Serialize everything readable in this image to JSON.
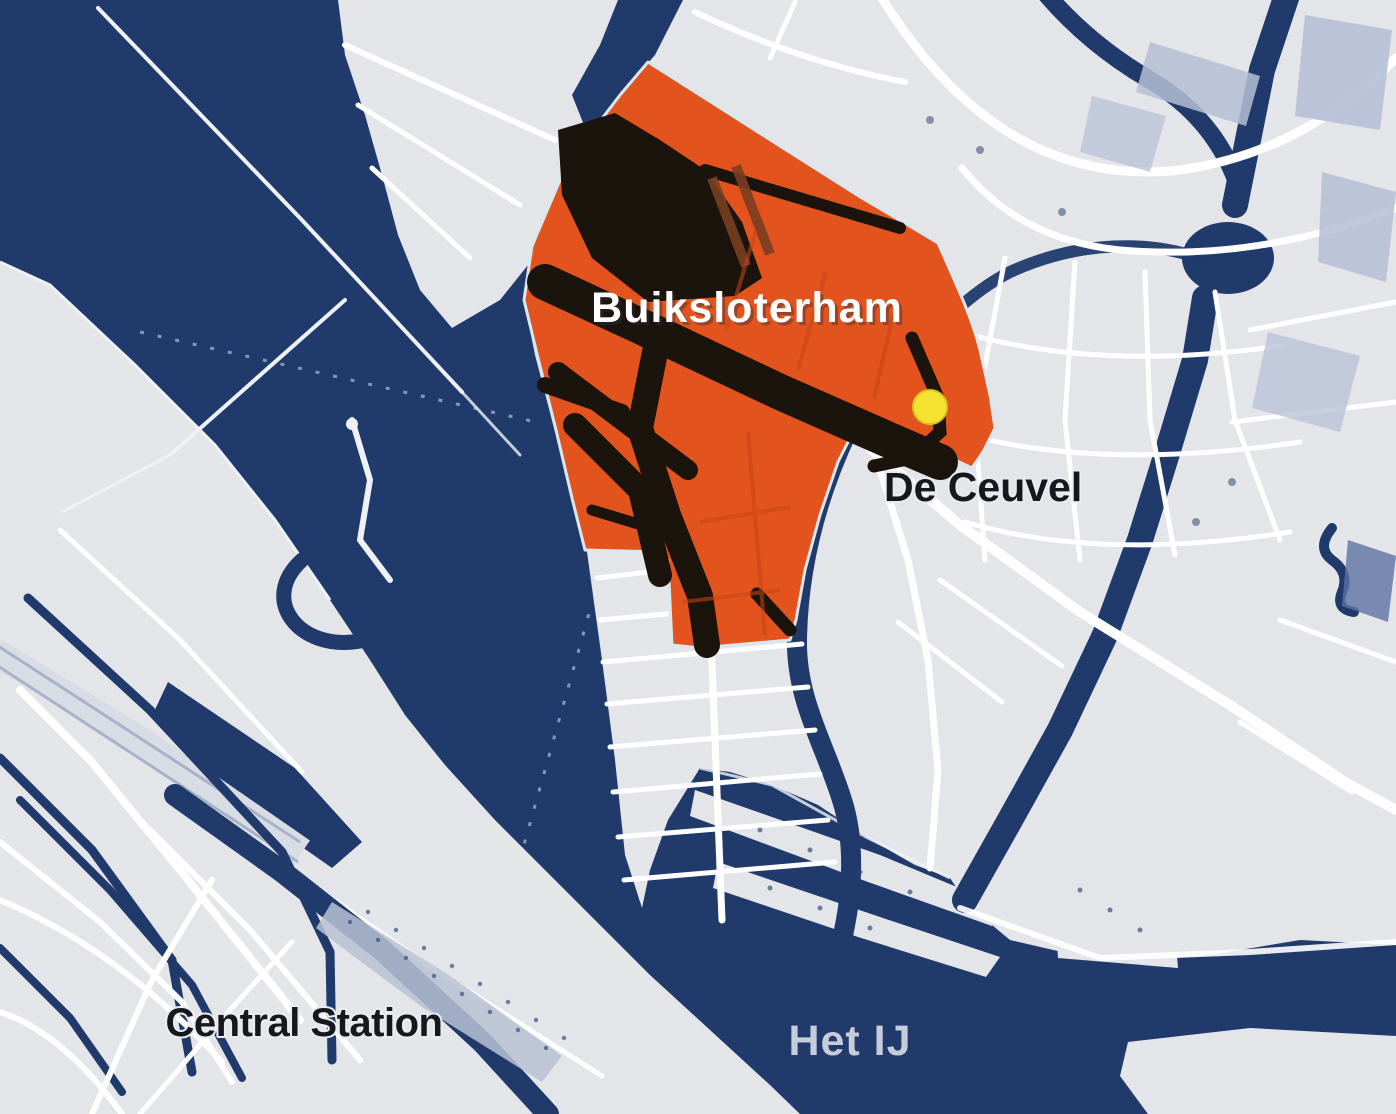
{
  "map": {
    "labels": {
      "region": "Buiksloterham",
      "poi": "De Ceuvel",
      "station": "Central Station",
      "water": "Het IJ"
    },
    "marker": {
      "name": "De Ceuvel location marker",
      "shape": "circle"
    },
    "regions": [
      {
        "name": "Buiksloterham",
        "type": "highlighted-district"
      },
      {
        "name": "De Ceuvel",
        "type": "point-of-interest"
      },
      {
        "name": "Central Station",
        "type": "transit-station"
      },
      {
        "name": "Het IJ",
        "type": "waterway"
      }
    ],
    "colors": {
      "water": "#1f3a6b",
      "land": "#e4e5e9",
      "highlight_region": "#e2531d",
      "region_roads": "#1b140c",
      "roads_white": "#ffffff",
      "buildings": "#b5bfd5",
      "label_dark": "#16181d",
      "label_light": "#c6ccd9",
      "marker_yellow": "#f6e331"
    }
  }
}
